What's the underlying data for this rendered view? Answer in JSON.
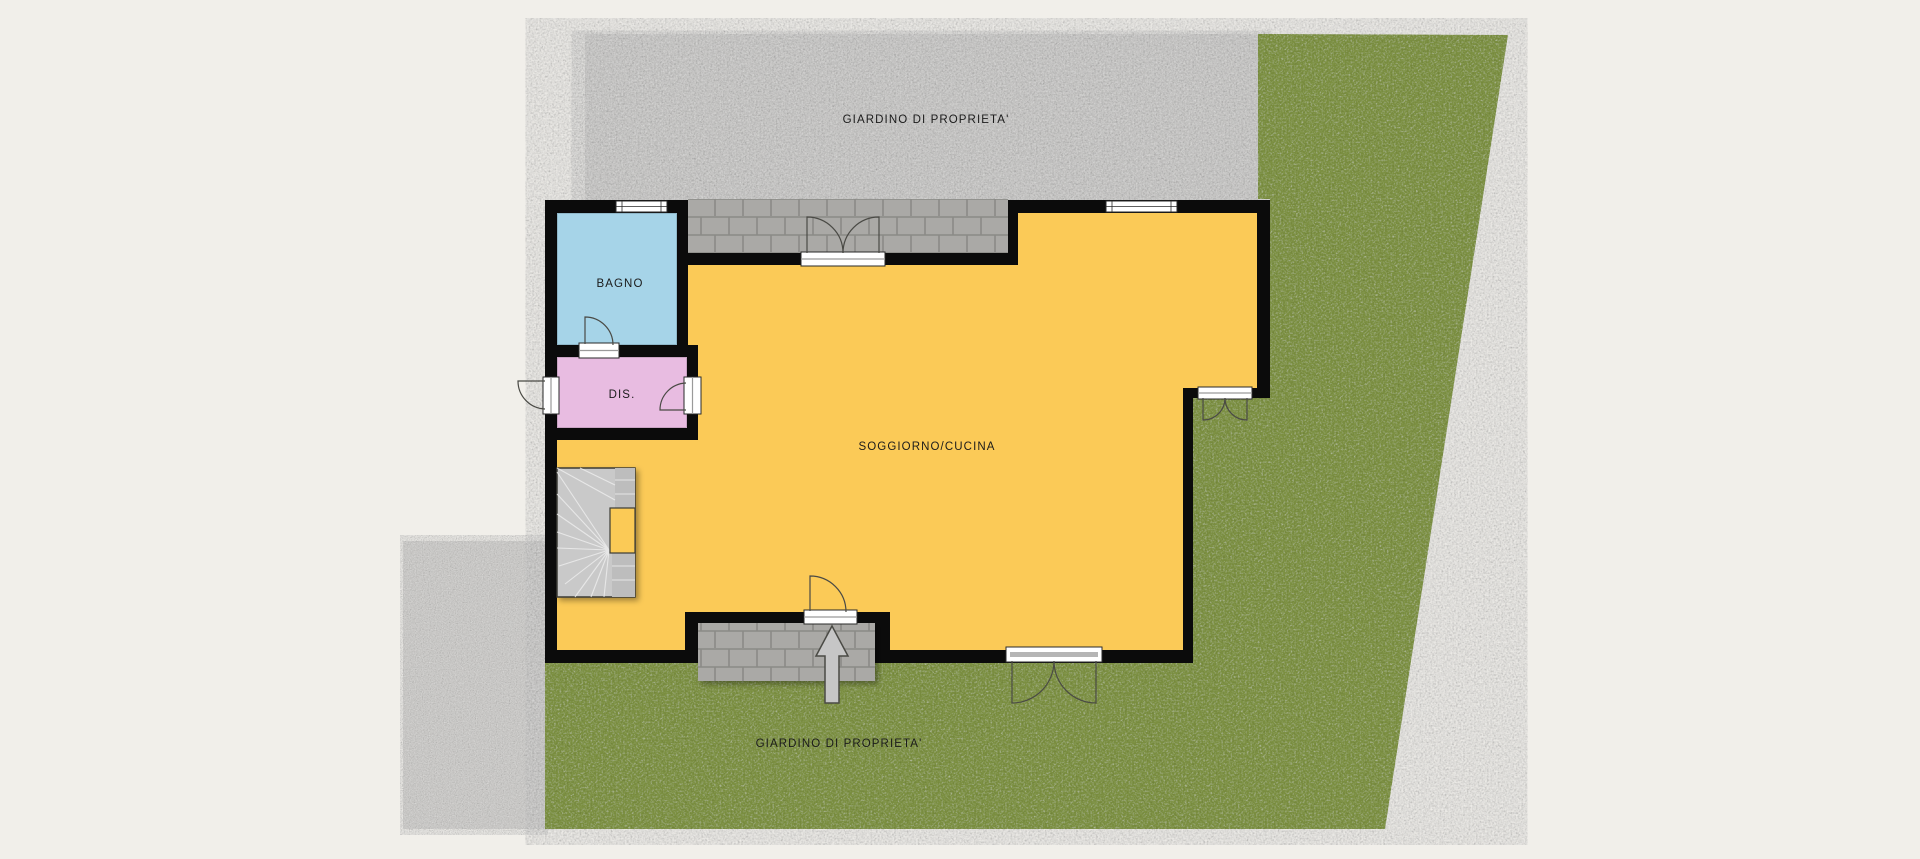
{
  "title": "Planimetria piano terra",
  "labels": {
    "garden_top": "GIARDINO DI PROPRIETA'",
    "garden_bottom": "GIARDINO DI PROPRIETA'",
    "bathroom": "BAGNO",
    "hallway": "DIS.",
    "living_kitchen": "SOGGIORNO/CUCINA"
  },
  "colors": {
    "background": "#F1EFEA",
    "wall": "#0B0B0B",
    "living_kitchen": "#FBCA57",
    "bathroom": "#A6D4E8",
    "hallway": "#E8BCE1",
    "gravel": "#C8C7C5",
    "grass": "#7D9142",
    "paving": "#AAA9A6",
    "paving_joint": "#8B8A87",
    "stairs": "#C9C9C9",
    "door_symbol": "#4A4A45"
  },
  "icons": {
    "entrance_arrow": "up-arrow"
  }
}
